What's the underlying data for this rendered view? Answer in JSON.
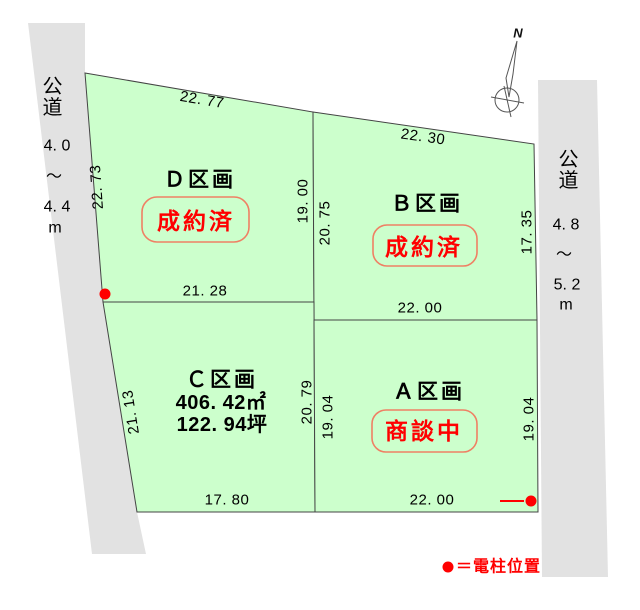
{
  "diagram_title": "land-subdivision-plan",
  "colors": {
    "plot_fill": "#ccffcc",
    "road_fill": "#e2e2e2",
    "outline": "#444444",
    "red": "#ff0000",
    "status_border": "#ef8064"
  },
  "compass": {
    "north_label": "N"
  },
  "roads": {
    "left": {
      "name_chars": [
        "公",
        "道"
      ],
      "width_label": [
        "4. 0",
        "〜",
        "4. 4",
        "m"
      ]
    },
    "right": {
      "name_chars": [
        "公",
        "道"
      ],
      "width_label": [
        "4. 8",
        "〜",
        "5. 2",
        "m"
      ]
    }
  },
  "plots": {
    "d": {
      "name": "Ｄ区画",
      "status": "成約済"
    },
    "b": {
      "name": "Ｂ区画",
      "status": "成約済"
    },
    "c": {
      "name": "Ｃ区画",
      "area_m2": "406. 42㎡",
      "area_tsubo": "122. 94坪"
    },
    "a": {
      "name": "Ａ区画",
      "status": "商談中"
    }
  },
  "dimensions": {
    "d": {
      "top": "22. 77",
      "left": "22. 73",
      "right": "19. 00",
      "bottom": "21. 28"
    },
    "b": {
      "top": "22. 30",
      "left": "20. 75",
      "right": "17. 35",
      "bottom": "22. 00"
    },
    "c": {
      "left": "21. 13",
      "right": "20. 79",
      "bottom": "17. 80"
    },
    "a": {
      "left": "19. 04",
      "right": "19. 04",
      "bottom": "22. 00"
    }
  },
  "legend": {
    "symbol": "●",
    "label": "＝電柱位置"
  }
}
